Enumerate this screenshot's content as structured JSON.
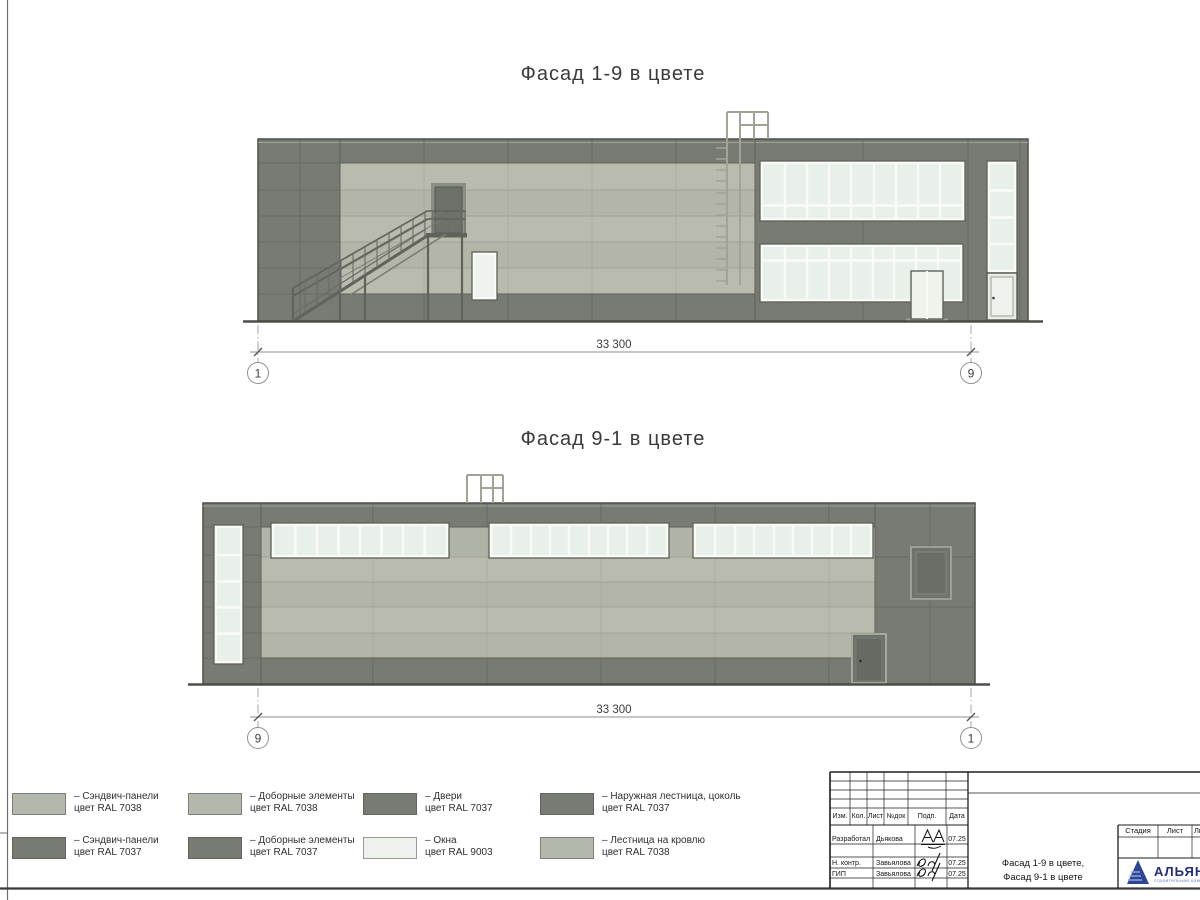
{
  "sheet": {
    "background": "#ffffff"
  },
  "titles": {
    "facade_top": "Фасад 1-9 в цвете",
    "facade_bottom": "Фасад 9-1 в цвете"
  },
  "facade_top": {
    "dimension": "33 300",
    "grid_left": "1",
    "grid_right": "9"
  },
  "facade_bottom": {
    "dimension": "33 300",
    "grid_left": "9",
    "grid_right": "1"
  },
  "colors": {
    "panel_light_ral7038": "#b6b9ad",
    "panel_dark_ral7037": "#787b73",
    "window_ral9003": "#eef2ec",
    "outline": "#4c4f49",
    "logo_blue": "#2c4596"
  },
  "legend": {
    "items": [
      {
        "line1": "– Сэндвич-панели",
        "line2": "цвет RAL 7038",
        "color": "#b4b7ab"
      },
      {
        "line1": "– Сэндвич-панели",
        "line2": "цвет RAL 7037",
        "color": "#787b73"
      },
      {
        "line1": "– Доборные элементы",
        "line2": "цвет RAL 7038",
        "color": "#b4b7ab"
      },
      {
        "line1": "– Доборные элементы",
        "line2": "цвет RAL 7037",
        "color": "#787b73"
      },
      {
        "line1": "– Двери",
        "line2": "цвет RAL 7037",
        "color": "#787b73"
      },
      {
        "line1": "– Окна",
        "line2": "цвет RAL 9003",
        "color": "#eef2ec"
      },
      {
        "line1": "– Наружная лестница, цоколь",
        "line2": "цвет RAL 7037",
        "color": "#787b73"
      },
      {
        "line1": "– Лестница на кровлю",
        "line2": "цвет RAL 7038",
        "color": "#b4b7ab"
      }
    ]
  },
  "title_block": {
    "header_cols": [
      "Изм.",
      "Кол.",
      "Лист",
      "№док",
      "Подп.",
      "Дата"
    ],
    "sign_rows": [
      {
        "role": "Разработал",
        "name": "Дьякова",
        "date": "07.25"
      },
      {
        "role": "Н. контр.",
        "name": "Завьялова",
        "date": "07.25"
      },
      {
        "role": "ГИП",
        "name": "Завьялова",
        "date": "07.25"
      }
    ],
    "doc_title_line1": "Фасад 1-9 в цвете,",
    "doc_title_line2": "Фасад 9-1 в цвете",
    "stage_label": "Стадия",
    "sheet_label": "Лист",
    "sheets_label": "Листов",
    "company": "АЛЬЯНС",
    "company_sub": "строительная компания"
  }
}
